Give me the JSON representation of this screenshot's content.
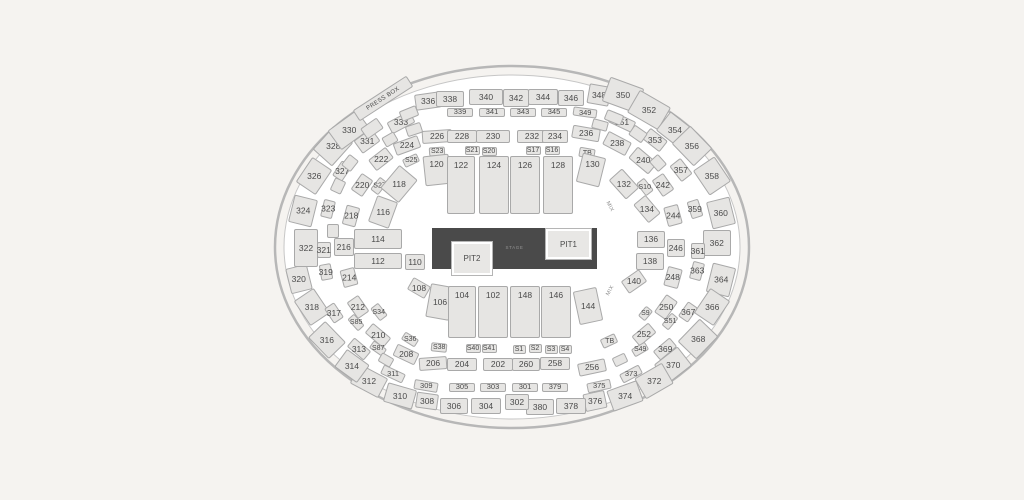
{
  "page": {
    "background": "#f5f3f0"
  },
  "map": {
    "cx": 512,
    "cy": 247,
    "outer_rx": 237,
    "outer_ry": 181,
    "inner_rx": 228,
    "inner_ry": 172,
    "ring_color": "#b7b7b7",
    "inner_ring_color": "#c6c6c6",
    "floor_color": "#ffffff",
    "section_fill": "#e6e5e3",
    "section_border": "#a9a9a9",
    "label_color": "#4a4a4a",
    "stage": {
      "label": "STAGE",
      "x": 432,
      "y": 228,
      "w": 165,
      "h": 41,
      "fill": "#4a4a4a",
      "label_color": "#939393"
    },
    "pits": [
      {
        "label": "PIT1",
        "x": 546,
        "y": 229,
        "w": 45,
        "h": 30
      },
      {
        "label": "PIT2",
        "x": 452,
        "y": 242,
        "w": 40,
        "h": 33
      }
    ],
    "press_box": {
      "label": "PRESS BOX",
      "x": 351,
      "y": 92,
      "w": 64,
      "h": 13,
      "rot": -33
    },
    "mix_labels": [
      {
        "label": "MIX",
        "x": 609,
        "y": 207,
        "rot": 62
      },
      {
        "label": "MIX",
        "x": 611,
        "y": 291,
        "rot": -62
      }
    ],
    "sections": [
      [
        "328",
        333,
        146,
        32,
        26,
        -48
      ],
      [
        "330",
        349,
        130,
        36,
        24,
        -36
      ],
      [
        "336",
        428,
        101,
        26,
        16,
        -8
      ],
      [
        "338",
        450,
        99,
        28,
        16,
        0
      ],
      [
        "340",
        486,
        97,
        34,
        16,
        0
      ],
      [
        "342",
        516,
        98,
        26,
        18,
        0
      ],
      [
        "344",
        543,
        97,
        30,
        16,
        0
      ],
      [
        "346",
        571,
        98,
        26,
        16,
        0
      ],
      [
        "348",
        599,
        95,
        22,
        20,
        10
      ],
      [
        "350",
        623,
        95,
        36,
        26,
        20
      ],
      [
        "352",
        649,
        110,
        36,
        26,
        30
      ],
      [
        "354",
        675,
        130,
        30,
        24,
        38
      ],
      [
        "356",
        692,
        146,
        32,
        26,
        46
      ],
      [
        "358",
        712,
        176,
        30,
        26,
        56
      ],
      [
        "360",
        721,
        213,
        28,
        24,
        76
      ],
      [
        "362",
        717,
        243,
        26,
        28,
        90
      ],
      [
        "364",
        721,
        280,
        30,
        24,
        -76
      ],
      [
        "366",
        712,
        307,
        30,
        24,
        -56
      ],
      [
        "368",
        698,
        339,
        32,
        26,
        -46
      ],
      [
        "370",
        673,
        365,
        30,
        24,
        -38
      ],
      [
        "372",
        654,
        381,
        32,
        24,
        -30
      ],
      [
        "374",
        625,
        396,
        32,
        22,
        -20
      ],
      [
        "376",
        595,
        401,
        22,
        18,
        -12
      ],
      [
        "378",
        571,
        406,
        30,
        16,
        0
      ],
      [
        "380",
        540,
        407,
        28,
        16,
        0
      ],
      [
        "302",
        517,
        402,
        24,
        16,
        0
      ],
      [
        "304",
        486,
        406,
        30,
        16,
        0
      ],
      [
        "306",
        454,
        406,
        28,
        16,
        0
      ],
      [
        "308",
        427,
        401,
        22,
        16,
        8
      ],
      [
        "310",
        400,
        396,
        30,
        20,
        16
      ],
      [
        "312",
        369,
        381,
        32,
        22,
        28
      ],
      [
        "314",
        352,
        366,
        28,
        22,
        36
      ],
      [
        "316",
        327,
        340,
        30,
        24,
        46
      ],
      [
        "318",
        312,
        307,
        30,
        24,
        56
      ],
      [
        "320",
        299,
        279,
        26,
        22,
        76
      ],
      [
        "322",
        306,
        248,
        24,
        38,
        0
      ],
      [
        "324",
        303,
        211,
        28,
        24,
        -76
      ],
      [
        "326",
        314,
        176,
        30,
        24,
        -56
      ],
      [
        "331",
        367,
        141,
        22,
        16,
        -36
      ],
      [
        "333",
        401,
        122,
        26,
        13,
        -28
      ],
      [
        "339",
        460,
        112,
        26,
        9,
        0,
        7.5
      ],
      [
        "341",
        492,
        112,
        26,
        9,
        0,
        7.5
      ],
      [
        "343",
        523,
        112,
        26,
        9,
        0,
        7.5
      ],
      [
        "345",
        554,
        112,
        26,
        9,
        0,
        7.5
      ],
      [
        "349",
        585,
        112,
        24,
        9,
        8,
        7.5
      ],
      [
        "351",
        622,
        122,
        26,
        12,
        25
      ],
      [
        "353",
        655,
        140,
        22,
        14,
        38
      ],
      [
        "357",
        681,
        170,
        20,
        14,
        52
      ],
      [
        "359",
        695,
        209,
        18,
        12,
        72
      ],
      [
        "361",
        698,
        251,
        16,
        14,
        90
      ],
      [
        "363",
        697,
        271,
        18,
        12,
        -75
      ],
      [
        "367",
        688,
        312,
        18,
        12,
        -55
      ],
      [
        "369",
        665,
        349,
        22,
        12,
        -40
      ],
      [
        "373",
        631,
        374,
        22,
        10,
        -28,
        7.5
      ],
      [
        "375",
        599,
        386,
        24,
        10,
        -12,
        7.5
      ],
      [
        "379",
        555,
        387,
        26,
        9,
        0,
        7.5
      ],
      [
        "301",
        525,
        387,
        26,
        9,
        0,
        7.5
      ],
      [
        "303",
        493,
        387,
        26,
        9,
        0,
        7.5
      ],
      [
        "305",
        462,
        387,
        26,
        9,
        0,
        7.5
      ],
      [
        "309",
        426,
        386,
        24,
        10,
        10,
        7.5
      ],
      [
        "311",
        393,
        374,
        24,
        10,
        25,
        7.5
      ],
      [
        "313",
        359,
        349,
        22,
        12,
        40
      ],
      [
        "317",
        334,
        313,
        18,
        12,
        56
      ],
      [
        "319",
        326,
        272,
        16,
        12,
        80
      ],
      [
        "321",
        324,
        250,
        16,
        14,
        90
      ],
      [
        "323",
        328,
        209,
        18,
        12,
        -76
      ],
      [
        "327",
        342,
        171,
        18,
        12,
        -56
      ],
      [
        "224",
        407,
        145,
        26,
        13,
        -20
      ],
      [
        "226",
        437,
        136,
        30,
        13,
        -4
      ],
      [
        "228",
        462,
        136,
        30,
        13,
        0
      ],
      [
        "230",
        493,
        136,
        34,
        13,
        0
      ],
      [
        "232",
        532,
        136,
        30,
        13,
        0
      ],
      [
        "234",
        555,
        136,
        26,
        13,
        0
      ],
      [
        "236",
        586,
        133,
        28,
        13,
        10
      ],
      [
        "238",
        617,
        143,
        26,
        15,
        28
      ],
      [
        "240",
        643,
        160,
        26,
        15,
        40
      ],
      [
        "242",
        663,
        185,
        20,
        14,
        55
      ],
      [
        "244",
        673,
        215,
        20,
        15,
        75
      ],
      [
        "246",
        676,
        248,
        18,
        18,
        90
      ],
      [
        "248",
        673,
        277,
        20,
        15,
        -75
      ],
      [
        "250",
        666,
        307,
        22,
        14,
        -55
      ],
      [
        "252",
        644,
        334,
        22,
        13,
        -40
      ],
      [
        "256",
        592,
        367,
        28,
        13,
        -12
      ],
      [
        "258",
        555,
        363,
        30,
        13,
        0
      ],
      [
        "260",
        526,
        364,
        28,
        13,
        0
      ],
      [
        "202",
        498,
        364,
        30,
        13,
        0
      ],
      [
        "204",
        462,
        364,
        30,
        13,
        0
      ],
      [
        "206",
        433,
        363,
        28,
        13,
        -4
      ],
      [
        "208",
        406,
        354,
        24,
        13,
        25
      ],
      [
        "210",
        378,
        335,
        24,
        13,
        40
      ],
      [
        "212",
        358,
        307,
        20,
        14,
        55
      ],
      [
        "214",
        349,
        277,
        18,
        15,
        75
      ],
      [
        "216",
        344,
        247,
        18,
        20,
        90
      ],
      [
        "218",
        351,
        216,
        20,
        14,
        -75
      ],
      [
        "220",
        362,
        185,
        20,
        14,
        -55
      ],
      [
        "222",
        381,
        159,
        22,
        14,
        -38
      ],
      [
        "S23",
        437,
        151,
        16,
        9,
        -4,
        7
      ],
      [
        "S21",
        472,
        150,
        15,
        9,
        0,
        7
      ],
      [
        "S20",
        489,
        151,
        15,
        9,
        0,
        7
      ],
      [
        "S17",
        533,
        150,
        15,
        9,
        0,
        7
      ],
      [
        "S16",
        552,
        150,
        15,
        9,
        0,
        7
      ],
      [
        "TB",
        587,
        153,
        16,
        10,
        10,
        7
      ],
      [
        "S25",
        411,
        160,
        16,
        9,
        -25,
        7
      ],
      [
        "S27",
        379,
        186,
        16,
        10,
        -52,
        7
      ],
      [
        "S10",
        645,
        187,
        16,
        10,
        52,
        7
      ],
      [
        "S34",
        379,
        312,
        16,
        10,
        52,
        7
      ],
      [
        "S36",
        410,
        339,
        16,
        9,
        32,
        7
      ],
      [
        "S38",
        439,
        347,
        16,
        9,
        6,
        7
      ],
      [
        "S40",
        473,
        348,
        15,
        9,
        0,
        7
      ],
      [
        "S41",
        489,
        348,
        15,
        9,
        0,
        7
      ],
      [
        "S1",
        519,
        349,
        13,
        9,
        0,
        7
      ],
      [
        "S2",
        535,
        348,
        13,
        9,
        0,
        7
      ],
      [
        "S3",
        551,
        349,
        13,
        9,
        0,
        7
      ],
      [
        "S4",
        565,
        349,
        13,
        9,
        0,
        7
      ],
      [
        "TB",
        609,
        341,
        16,
        10,
        -25,
        7
      ],
      [
        "S49",
        640,
        349,
        16,
        9,
        -30,
        7
      ],
      [
        "S51",
        670,
        321,
        16,
        9,
        -50,
        7
      ],
      [
        "S9",
        645,
        313,
        13,
        9,
        -50,
        7
      ],
      [
        "S85",
        356,
        322,
        16,
        9,
        48,
        7
      ],
      [
        "S87",
        378,
        348,
        16,
        9,
        35,
        7
      ],
      [
        "118",
        399,
        184,
        30,
        24,
        -50
      ],
      [
        "116",
        383,
        212,
        28,
        22,
        -70
      ],
      [
        "114",
        378,
        239,
        48,
        20,
        0
      ],
      [
        "112",
        378,
        261,
        48,
        16,
        0
      ],
      [
        "110",
        415,
        262,
        20,
        16,
        0
      ],
      [
        "108",
        419,
        288,
        20,
        14,
        30
      ],
      [
        "106",
        440,
        302,
        24,
        34,
        10
      ],
      [
        "144",
        588,
        306,
        24,
        34,
        -12
      ],
      [
        "104",
        462,
        312,
        28,
        52,
        0,
        8.5,
        "top"
      ],
      [
        "102",
        493,
        312,
        30,
        52,
        0,
        8.5,
        "top"
      ],
      [
        "148",
        525,
        312,
        30,
        52,
        0,
        8.5,
        "top"
      ],
      [
        "146",
        556,
        312,
        30,
        52,
        0,
        8.5,
        "top"
      ],
      [
        "140",
        634,
        281,
        22,
        15,
        -35
      ],
      [
        "138",
        650,
        261,
        28,
        17,
        0
      ],
      [
        "136",
        651,
        239,
        28,
        17,
        0
      ],
      [
        "134",
        647,
        209,
        24,
        16,
        50
      ],
      [
        "132",
        624,
        184,
        26,
        18,
        48
      ],
      [
        "130",
        591,
        170,
        24,
        30,
        14,
        8.5,
        "top"
      ],
      [
        "120",
        437,
        170,
        26,
        30,
        -6,
        8.5,
        "top"
      ],
      [
        "122",
        461,
        185,
        28,
        58,
        0,
        8.5,
        "top"
      ],
      [
        "124",
        494,
        185,
        30,
        58,
        0,
        8.5,
        "top"
      ],
      [
        "126",
        525,
        185,
        30,
        58,
        0,
        8.5,
        "top"
      ],
      [
        "128",
        558,
        185,
        30,
        58,
        0,
        8.5,
        "top"
      ]
    ],
    "fillers": [
      [
        "",
        409,
        113,
        18,
        11,
        -22
      ],
      [
        "",
        372,
        128,
        20,
        13,
        -35
      ],
      [
        "",
        390,
        139,
        14,
        11,
        -30
      ],
      [
        "",
        614,
        117,
        18,
        11,
        22
      ],
      [
        "",
        638,
        134,
        16,
        12,
        35
      ],
      [
        "",
        658,
        163,
        14,
        12,
        48
      ],
      [
        "",
        350,
        163,
        14,
        12,
        -52
      ],
      [
        "",
        338,
        186,
        14,
        12,
        -65
      ],
      [
        "",
        333,
        231,
        12,
        14,
        0
      ],
      [
        "",
        386,
        360,
        14,
        10,
        30
      ],
      [
        "",
        620,
        360,
        14,
        10,
        -25
      ],
      [
        "",
        414,
        129,
        16,
        11,
        -18
      ],
      [
        "",
        600,
        125,
        16,
        10,
        15
      ]
    ]
  }
}
